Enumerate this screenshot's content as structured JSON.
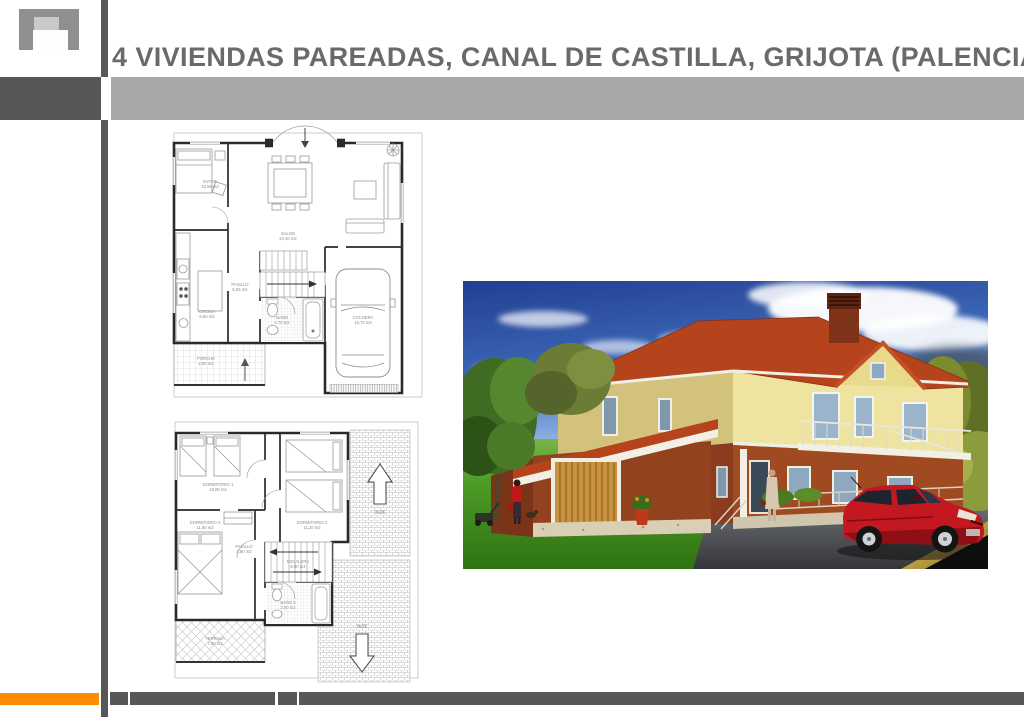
{
  "header": {
    "title": "4 VIVIENDAS PAREADAS, CANAL DE CASTILLA, GRIJOTA (PALENCIA)"
  },
  "colors": {
    "accent_orange": "#ff8c00",
    "bar_dark_gray": "#575757",
    "bar_light_gray": "#a8a8a8",
    "title_text": "#6a6a6a",
    "roof_red": "#b5431c",
    "brick_red": "#9a4520",
    "facade_cream": "#ede19c",
    "grass_green": "#3f8c1c",
    "sky_blue": "#2a4d9b",
    "car_red": "#c41820",
    "garage_door_wood": "#c8923e"
  },
  "plans": {
    "ground_floor": {
      "rooms": [
        {
          "name": "ESTAR",
          "area": "10,55 m2"
        },
        {
          "name": "SALON",
          "area": "24,40 m2"
        },
        {
          "name": "COCINA",
          "area": "8,60 m2"
        },
        {
          "name": "PASILLO",
          "area": "5,65 m2"
        },
        {
          "name": "BAÑO",
          "area": "4,70 m2"
        },
        {
          "name": "COCHERA",
          "area": "16,70 m2"
        },
        {
          "name": "PORCHE",
          "area": "2,00 m2"
        }
      ]
    },
    "first_floor": {
      "rooms": [
        {
          "name": "DORMITORIO 1",
          "area": "10,00 m2"
        },
        {
          "name": "DORMITORIO 2",
          "area": "11,20 m2"
        },
        {
          "name": "DORMITORIO 3",
          "area": "11,60 m2"
        },
        {
          "name": "PASILLO",
          "area": "3,80 m2"
        },
        {
          "name": "ESCALERA",
          "area": "6,00 m2"
        },
        {
          "name": "BAÑO 2",
          "area": "3,00 m2"
        },
        {
          "name": "TERRAZA",
          "area": "7,60 m2"
        }
      ],
      "roof_slope_upper": "30%",
      "roof_slope_lower": "30%"
    }
  }
}
